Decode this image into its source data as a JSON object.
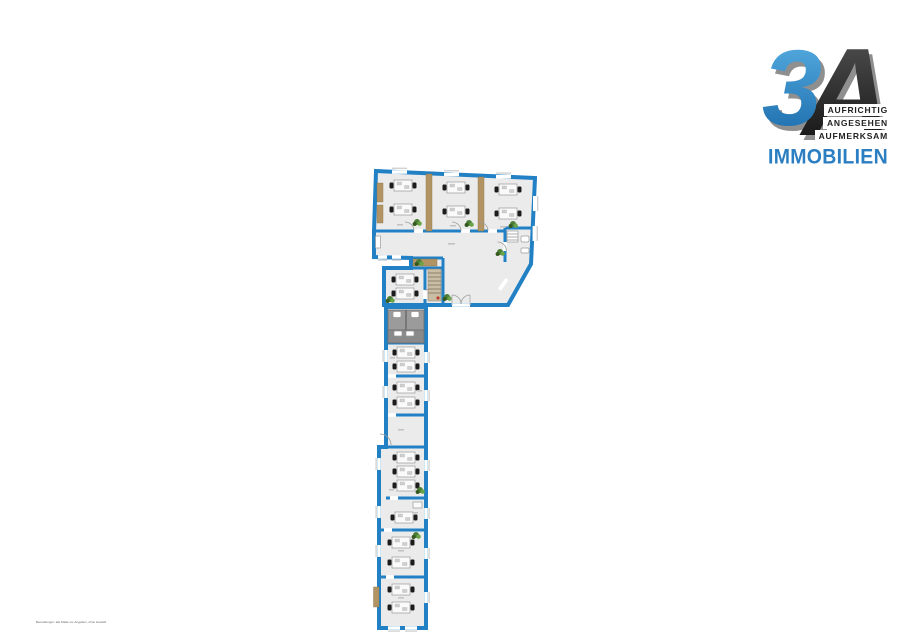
{
  "page": {
    "background": "#ffffff"
  },
  "logo": {
    "number": "3",
    "letter": "A",
    "tagline": [
      "AUFRICHTIG",
      "ANGESEHEN",
      "AUFMERKSAM"
    ],
    "brand": "IMMOBILIEN",
    "colors": {
      "number_top": "#5cb3e6",
      "number_bottom": "#1767a8",
      "letter_top": "#555555",
      "letter_bottom": "#0d0d0d",
      "shadow": "#8f8f8f",
      "brand_blue": "#2b7ec2",
      "tagline_text": "#222222"
    }
  },
  "floorplan": {
    "type": "office-floor-plan",
    "colors": {
      "page_bg": "#ffffff",
      "wall": "#2280c4",
      "floor": "#ebebeb",
      "partition": "#b29464",
      "wc_stall": "#9b9b9b",
      "wc_floor": "#8a8a8a",
      "fixture": "#ffffff",
      "furniture_table": "#fafafa",
      "chair": "#1c1c1c",
      "plant": "#4a7d36",
      "sill": "#d2d2d2",
      "door_arc": "#9b9b9b",
      "label": "#c2c2c2",
      "accent_red": "#c0392b",
      "stair": "#c9bda4"
    },
    "rooms": [
      {
        "name": "office-top-1",
        "desk_groups": 2
      },
      {
        "name": "office-top-2",
        "desk_groups": 2
      },
      {
        "name": "office-top-3",
        "desk_groups": 2
      },
      {
        "name": "corridor",
        "desk_groups": 0
      },
      {
        "name": "wc-top-right",
        "desk_groups": 0
      },
      {
        "name": "meeting-room",
        "desk_groups": 2
      },
      {
        "name": "stair-nook",
        "desk_groups": 0
      },
      {
        "name": "wc-stalls",
        "desk_groups": 0
      },
      {
        "name": "washroom",
        "desk_groups": 0
      },
      {
        "name": "office-mid-1",
        "desk_groups": 2
      },
      {
        "name": "office-mid-2",
        "desk_groups": 2
      },
      {
        "name": "landing",
        "desk_groups": 0
      },
      {
        "name": "office-low-1",
        "desk_groups": 3
      },
      {
        "name": "office-low-2",
        "desk_groups": 1
      },
      {
        "name": "office-low-3",
        "desk_groups": 2
      },
      {
        "name": "office-low-4",
        "desk_groups": 2
      }
    ]
  },
  "footer": {
    "fine_print": "Bemaßungen: alle Maße ca.-Angaben, ohne Gewähr"
  }
}
